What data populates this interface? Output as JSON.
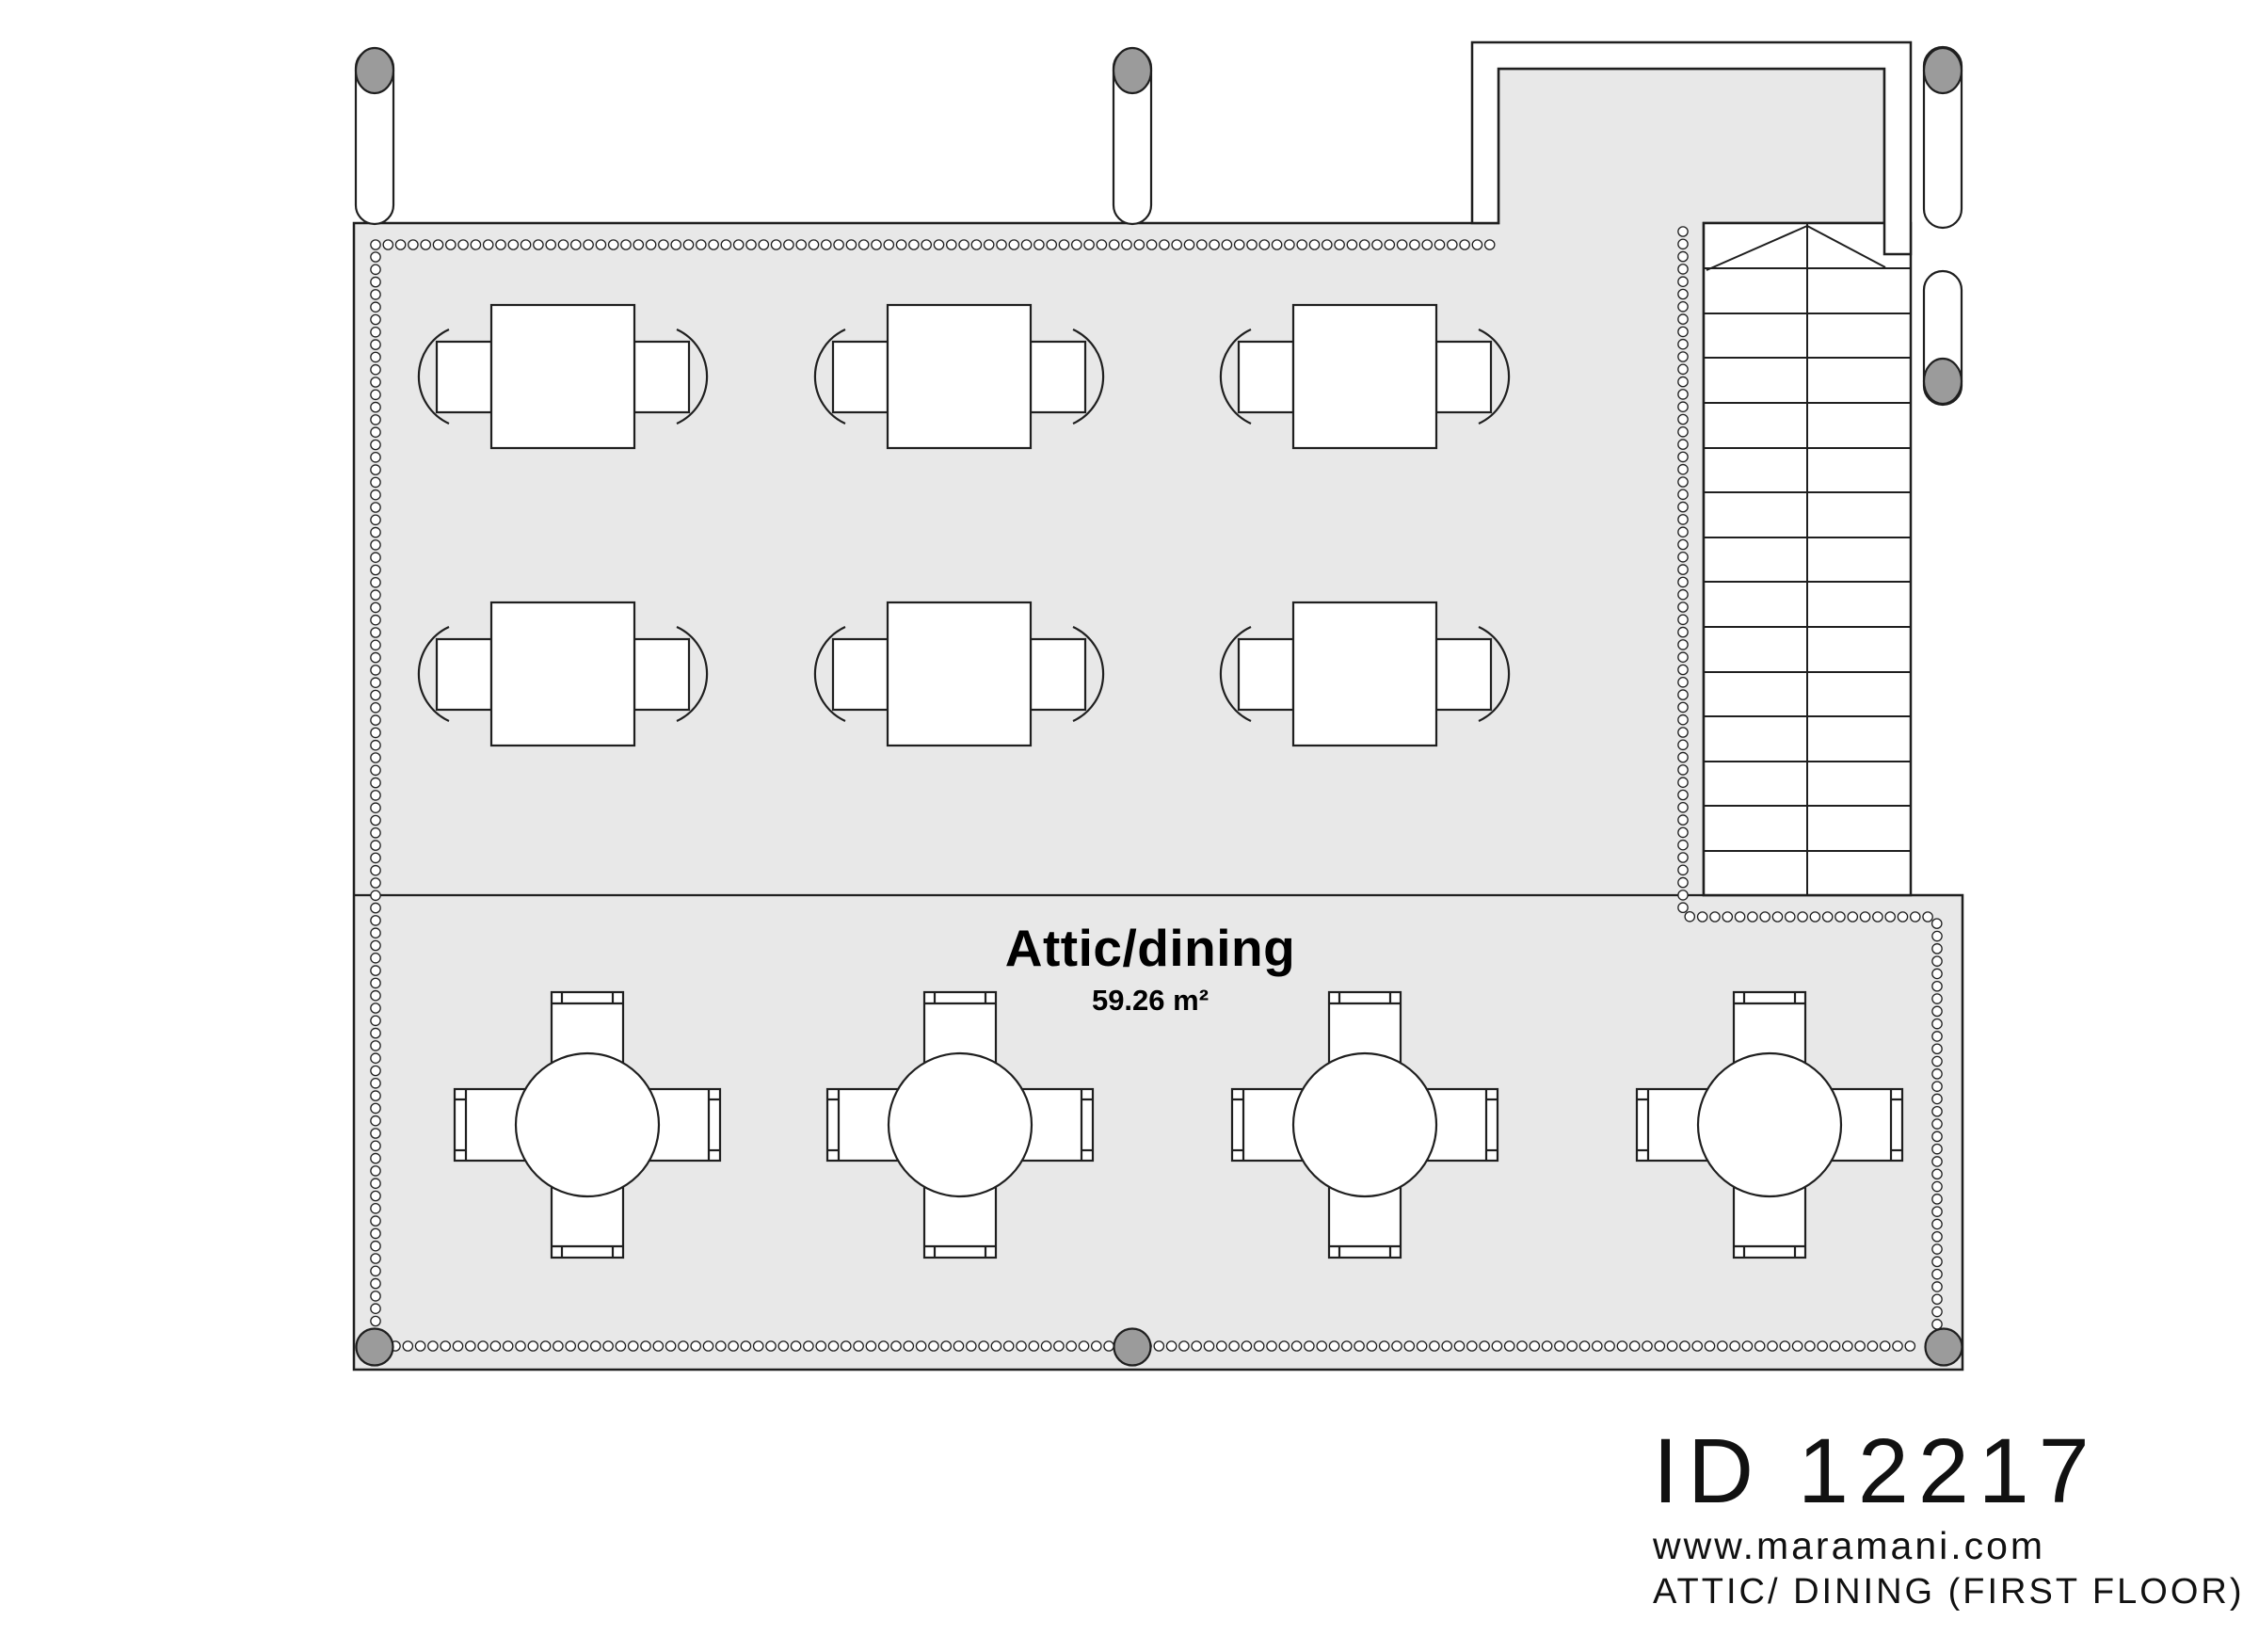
{
  "plan": {
    "room_label": "Attic/dining",
    "room_area": "59.26 m²"
  },
  "footer": {
    "plan_id": "ID 12217",
    "website": "www.maramani.com",
    "floor_label": "ATTIC/ DINING (FIRST FLOOR)"
  },
  "symbols": {
    "square_table": "square-table-2-seats",
    "round_table": "round-table-4-seats",
    "staircase": "staircase-up",
    "railing": "baluster-railing",
    "column": "roof-column"
  },
  "colors": {
    "background": "#ffffff",
    "floor": "#e8e8e8",
    "line": "#1f1f1f",
    "column_gray": "#9b9b9b",
    "furniture_fill": "#ffffff"
  }
}
